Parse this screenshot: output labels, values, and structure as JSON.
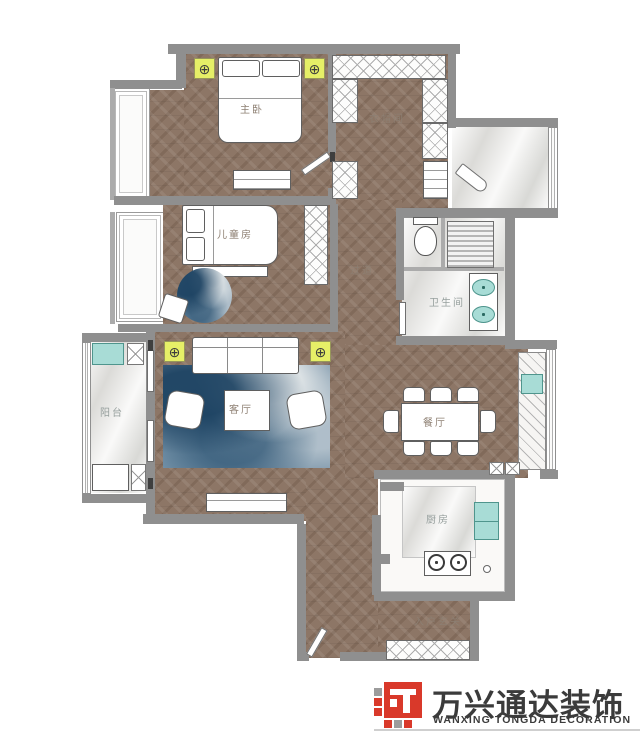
{
  "colors": {
    "wall": "#8f8f8f",
    "wood": "#8d7666",
    "marble": "#e9e8e5",
    "highlight_yellow": "#e6ef67",
    "fixture_teal": "#a8dcd6",
    "rug_blue": "#6e8aa0",
    "brand_red": "#d9392a",
    "label_text": "#8d7f72"
  },
  "rooms": {
    "master": {
      "label": "主卧"
    },
    "closet": {
      "label": "衣帽间"
    },
    "children": {
      "label": "儿童房"
    },
    "hallway": {
      "label": "过道"
    },
    "bathroom": {
      "label": "卫生间"
    },
    "balcony": {
      "label": "阳台"
    },
    "living": {
      "label": "客厅"
    },
    "dining": {
      "label": "餐厅"
    },
    "kitchen": {
      "label": "厨房"
    },
    "entry": {
      "label": "入户玄关"
    }
  },
  "fixtures": {
    "lamp_symbol": "⊕"
  },
  "brand": {
    "name_cn": "万兴通达装饰",
    "name_en": "WANXING TONGDA DECORATION"
  }
}
